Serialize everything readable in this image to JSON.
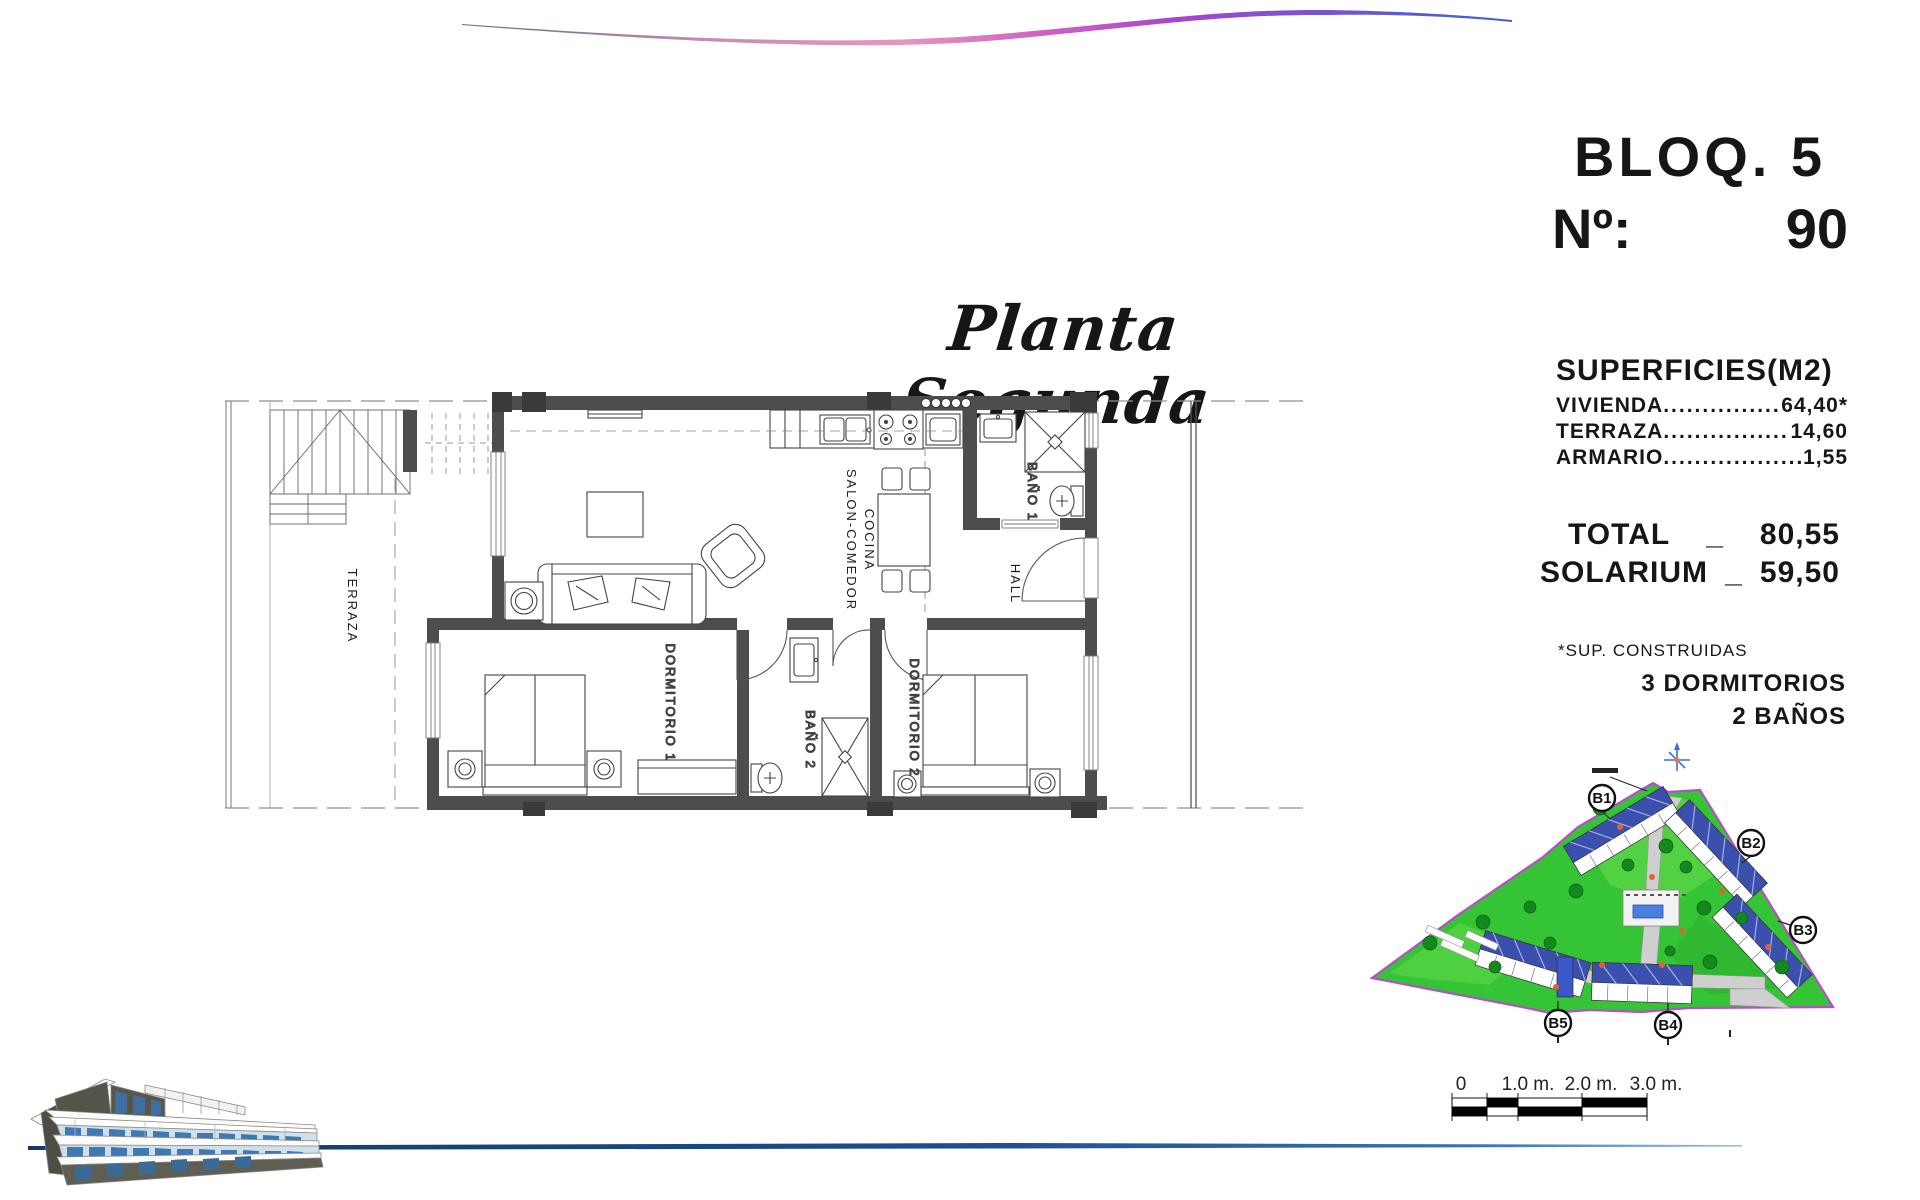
{
  "header": {
    "title": "Planta Segunda"
  },
  "unit": {
    "block": "BLOQ. 5",
    "number_label": "Nº:",
    "number_value": "90"
  },
  "surfaces": {
    "heading": "SUPERFICIES(M2)",
    "rows": [
      {
        "label": "VIVIENDA",
        "dots": "......................................",
        "value": "64,40*"
      },
      {
        "label": "TERRAZA",
        "dots": "......................................",
        "value": "14,60"
      },
      {
        "label": "ARMARIO",
        "dots": "........................................",
        "value": "1,55"
      }
    ],
    "total": {
      "label": "TOTAL",
      "sep": "_",
      "value": "80,55"
    },
    "solarium": {
      "label": "SOLARIUM",
      "sep": "_",
      "value": "59,50"
    },
    "footnote": "*SUP. CONSTRUIDAS",
    "bedrooms": "3 DORMITORIOS",
    "bathrooms": "2 BAÑOS"
  },
  "floor_plan": {
    "labels": {
      "terraza": "TERRAZA",
      "salon": "SALON-COMEDOR",
      "cocina": "COCINA",
      "bano1": "BAÑO 1",
      "hall": "HALL",
      "dorm1": "DORMITORIO 1",
      "bano2": "BAÑO 2",
      "dorm2": "DORMITORIO 2"
    }
  },
  "site_plan": {
    "blocks": [
      "B1",
      "B2",
      "B3",
      "B4",
      "B5"
    ],
    "land_color": "#35c435",
    "border_color": "#b44fc8",
    "pool_color": "#4a7fe0"
  },
  "scale_bar": {
    "labels": [
      "0",
      "1.0 m.",
      "2.0 m.",
      "3.0 m."
    ]
  },
  "footer": {
    "line_color": "#123a66"
  }
}
